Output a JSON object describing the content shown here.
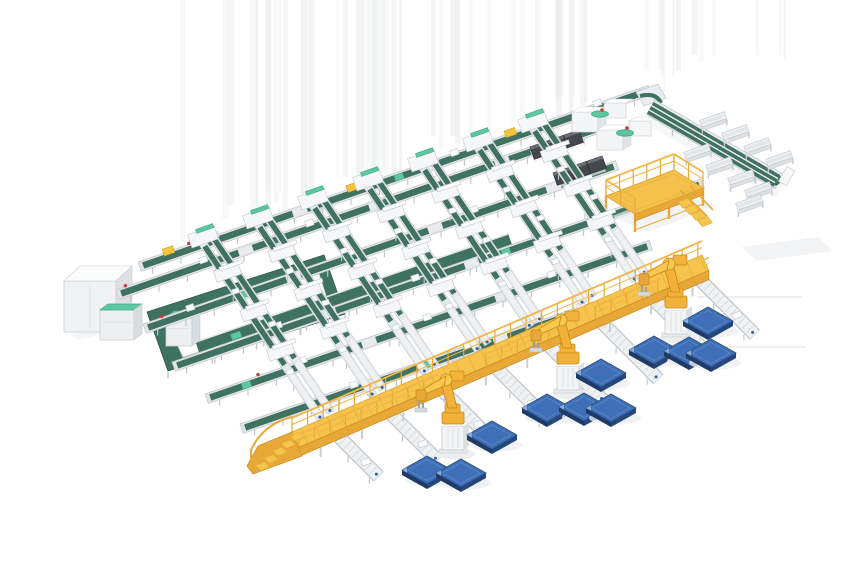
{
  "meta": {
    "description": "Isometric 3D render of an automated conveyor sorting and robotic palletizing system: green belt conveyor grid, yellow elevated walkway with stairs, telescopic loaders, yellow palletizing robots and blue pallets on a white floor",
    "width": 860,
    "height": 580
  },
  "colors": {
    "belt_green": "#3F7260",
    "belt_green_dark": "#2E5849",
    "mint": "#5FC6A2",
    "mint_dark": "#3FA985",
    "frame_base": "#E2E5E8",
    "frame_light": "#F2F4F5",
    "frame_mid": "#D9DDE0",
    "frame_dark": "#C2C7CC",
    "roller": "#EFF1F2",
    "tick": "#DADDE0",
    "yellow": "#F6C44D",
    "yellow_mid": "#E8A838",
    "yellow_dark": "#DFA42F",
    "yellow_deep": "#C8861F",
    "yellow_rail": "#EFB647",
    "robot_yellow": "#F2B23A",
    "robot_light": "#F7C94F",
    "robot_edge": "#C58A18",
    "robot_wrist": "#E9A63A",
    "pallet_top": "#3E6FB7",
    "pallet_side": "#26477A",
    "pallet_side2": "#1E3A65",
    "pallet_inner": "#5C88C4",
    "pallet_glint": "#8FB2DC",
    "machine_dark": "#44474C",
    "machine_top": "#6B6F75",
    "machine_line": "#2E3135",
    "white": "#FFFFFF",
    "box_front": "#F0F2F3",
    "box_side": "#DCE0E3",
    "box_top": "#FAFBFB",
    "item_yellow": "#F4C53F",
    "item_yellow_edge": "#C99A18",
    "red": "#C24034",
    "blue_dot": "#2B5FA8",
    "shadow": "#ECEEEF",
    "streak": "#EBEDEE",
    "faint_line": "#E3E5E6",
    "gray_leg": "#C9CED3"
  },
  "scene": {
    "streaks": {
      "seed": 13,
      "count": 62,
      "x_min": 155,
      "x_max": 785,
      "w_min": 1.5,
      "w_max": 7
    },
    "main_lines": [
      {
        "x": 138,
        "y": 262,
        "len": 540,
        "gaps": [
          0.3,
          0.56
        ],
        "items": [
          0.15,
          0.36,
          0.62,
          0.9
        ],
        "mints": [
          0.5,
          0.85
        ],
        "reds": [
          0.1
        ],
        "yellows": [
          0.06,
          0.42,
          0.73,
          0.79
        ]
      },
      {
        "x": 116,
        "y": 290,
        "len": 512,
        "gaps": [
          0.25,
          0.52,
          0.78
        ],
        "items": [
          0.18,
          0.4,
          0.66
        ],
        "mints": [
          0.33
        ],
        "reds": [
          0.02,
          0.45
        ],
        "yellows": []
      },
      {
        "x": 143,
        "y": 324,
        "len": 500,
        "gaps": [
          0.3,
          0.6,
          0.85
        ],
        "items": [
          0.1,
          0.44,
          0.7,
          0.92
        ],
        "mints": [
          0.2
        ],
        "reds": [
          0.04
        ],
        "yellows": []
      },
      {
        "x": 172,
        "y": 362,
        "len": 560,
        "gaps": [
          0.28,
          0.55,
          0.8
        ],
        "items": [
          0.2,
          0.46,
          0.7
        ],
        "mints": [
          0.62
        ],
        "reds": [
          0.3
        ],
        "yellows": []
      },
      {
        "x": 205,
        "y": 394,
        "len": 470,
        "gaps": [
          0.35,
          0.65
        ],
        "items": [
          0.22,
          0.5,
          0.78
        ],
        "mints": [
          0.08
        ],
        "reds": [
          0.12
        ],
        "yellows": []
      },
      {
        "x": 240,
        "y": 424,
        "len": 430,
        "gaps": [
          0.3,
          0.62
        ],
        "items": [
          0.28,
          0.56,
          0.84
        ],
        "mints": [
          0.45
        ],
        "reds": [],
        "yellows": []
      }
    ],
    "spurs": [
      [
        197,
        242,
        216
      ],
      [
        252,
        223,
        211
      ],
      [
        307,
        204,
        206
      ],
      [
        362,
        185,
        202
      ],
      [
        417,
        166,
        197
      ],
      [
        472,
        146,
        193
      ],
      [
        527,
        127,
        188
      ]
    ],
    "lanes": [
      [
        335,
        442,
        55
      ],
      [
        387,
        419,
        65
      ],
      [
        439,
        396,
        72
      ],
      [
        492,
        373,
        75
      ],
      [
        544,
        350,
        78
      ],
      [
        597,
        327,
        80
      ],
      [
        649,
        304,
        85
      ],
      [
        695,
        284,
        78
      ]
    ],
    "walkway": {
      "x1": 292,
      "y1": 432,
      "x2": 702,
      "y2": 255,
      "width": 17,
      "skirt": 9,
      "lower_rail_gaps": [
        [
          0.34,
          0.45
        ],
        [
          0.63,
          0.72
        ],
        [
          0.88,
          0.99
        ]
      ]
    },
    "robots": [
      [
        453,
        452
      ],
      [
        568,
        392
      ],
      [
        676,
        336
      ]
    ],
    "pallets": [
      [
        427,
        470
      ],
      [
        461,
        473
      ],
      [
        492,
        435
      ],
      [
        547,
        408
      ],
      [
        584,
        407
      ],
      [
        611,
        408
      ],
      [
        601,
        373
      ],
      [
        654,
        350
      ],
      [
        689,
        351
      ],
      [
        711,
        353
      ],
      [
        708,
        321
      ]
    ],
    "machines": [
      {
        "boom": [
          530,
          147
        ],
        "boom_len": 52,
        "housing": [
          572,
          112
        ],
        "extra": [
          604,
          103
        ],
        "teal": [
          600,
          114
        ],
        "red": [
          602,
          110
        ]
      },
      {
        "boom": [
          553,
          173
        ],
        "boom_len": 52,
        "housing": [
          597,
          130
        ],
        "extra": [
          629,
          121
        ],
        "teal": [
          625,
          133
        ],
        "red": [
          627,
          128
        ]
      }
    ],
    "wing": {
      "x": 655,
      "y": 100,
      "len": 148,
      "strips": 3
    },
    "benches": [
      [
        696,
        148
      ],
      [
        718,
        161
      ],
      [
        740,
        174
      ],
      [
        757,
        186
      ],
      [
        712,
        116
      ],
      [
        734,
        129
      ],
      [
        756,
        142
      ],
      [
        778,
        155
      ],
      [
        748,
        199
      ]
    ],
    "platform": {
      "d1": [
        606,
        196
      ],
      "d2": [
        674,
        170
      ],
      "d3": [
        703,
        188
      ],
      "d4": [
        635,
        214
      ]
    },
    "white_box": {
      "x": 64,
      "y": 281,
      "w": 52,
      "h": 51
    },
    "cabinets": [
      {
        "x": 100,
        "y": 310,
        "w": 34,
        "h": 30
      },
      {
        "x": 166,
        "y": 317,
        "w": 26,
        "h": 29
      }
    ],
    "loop": {
      "outer": [
        [
          147,
          312
        ],
        [
          324,
          255
        ],
        [
          345,
          314
        ],
        [
          168,
          371
        ]
      ],
      "inner": [
        [
          166,
          319
        ],
        [
          317,
          268
        ],
        [
          330,
          308
        ],
        [
          183,
          357
        ]
      ]
    },
    "wide_belt": {
      "x": 196,
      "y": 342,
      "len": 330,
      "w": 19
    },
    "faint_lines": [
      [
        697,
        297,
        802,
        297
      ],
      [
        724,
        347,
        806,
        347
      ]
    ],
    "end_shadow": [
      [
        742,
        247
      ],
      [
        818,
        237
      ],
      [
        833,
        251
      ],
      [
        757,
        261
      ]
    ]
  }
}
